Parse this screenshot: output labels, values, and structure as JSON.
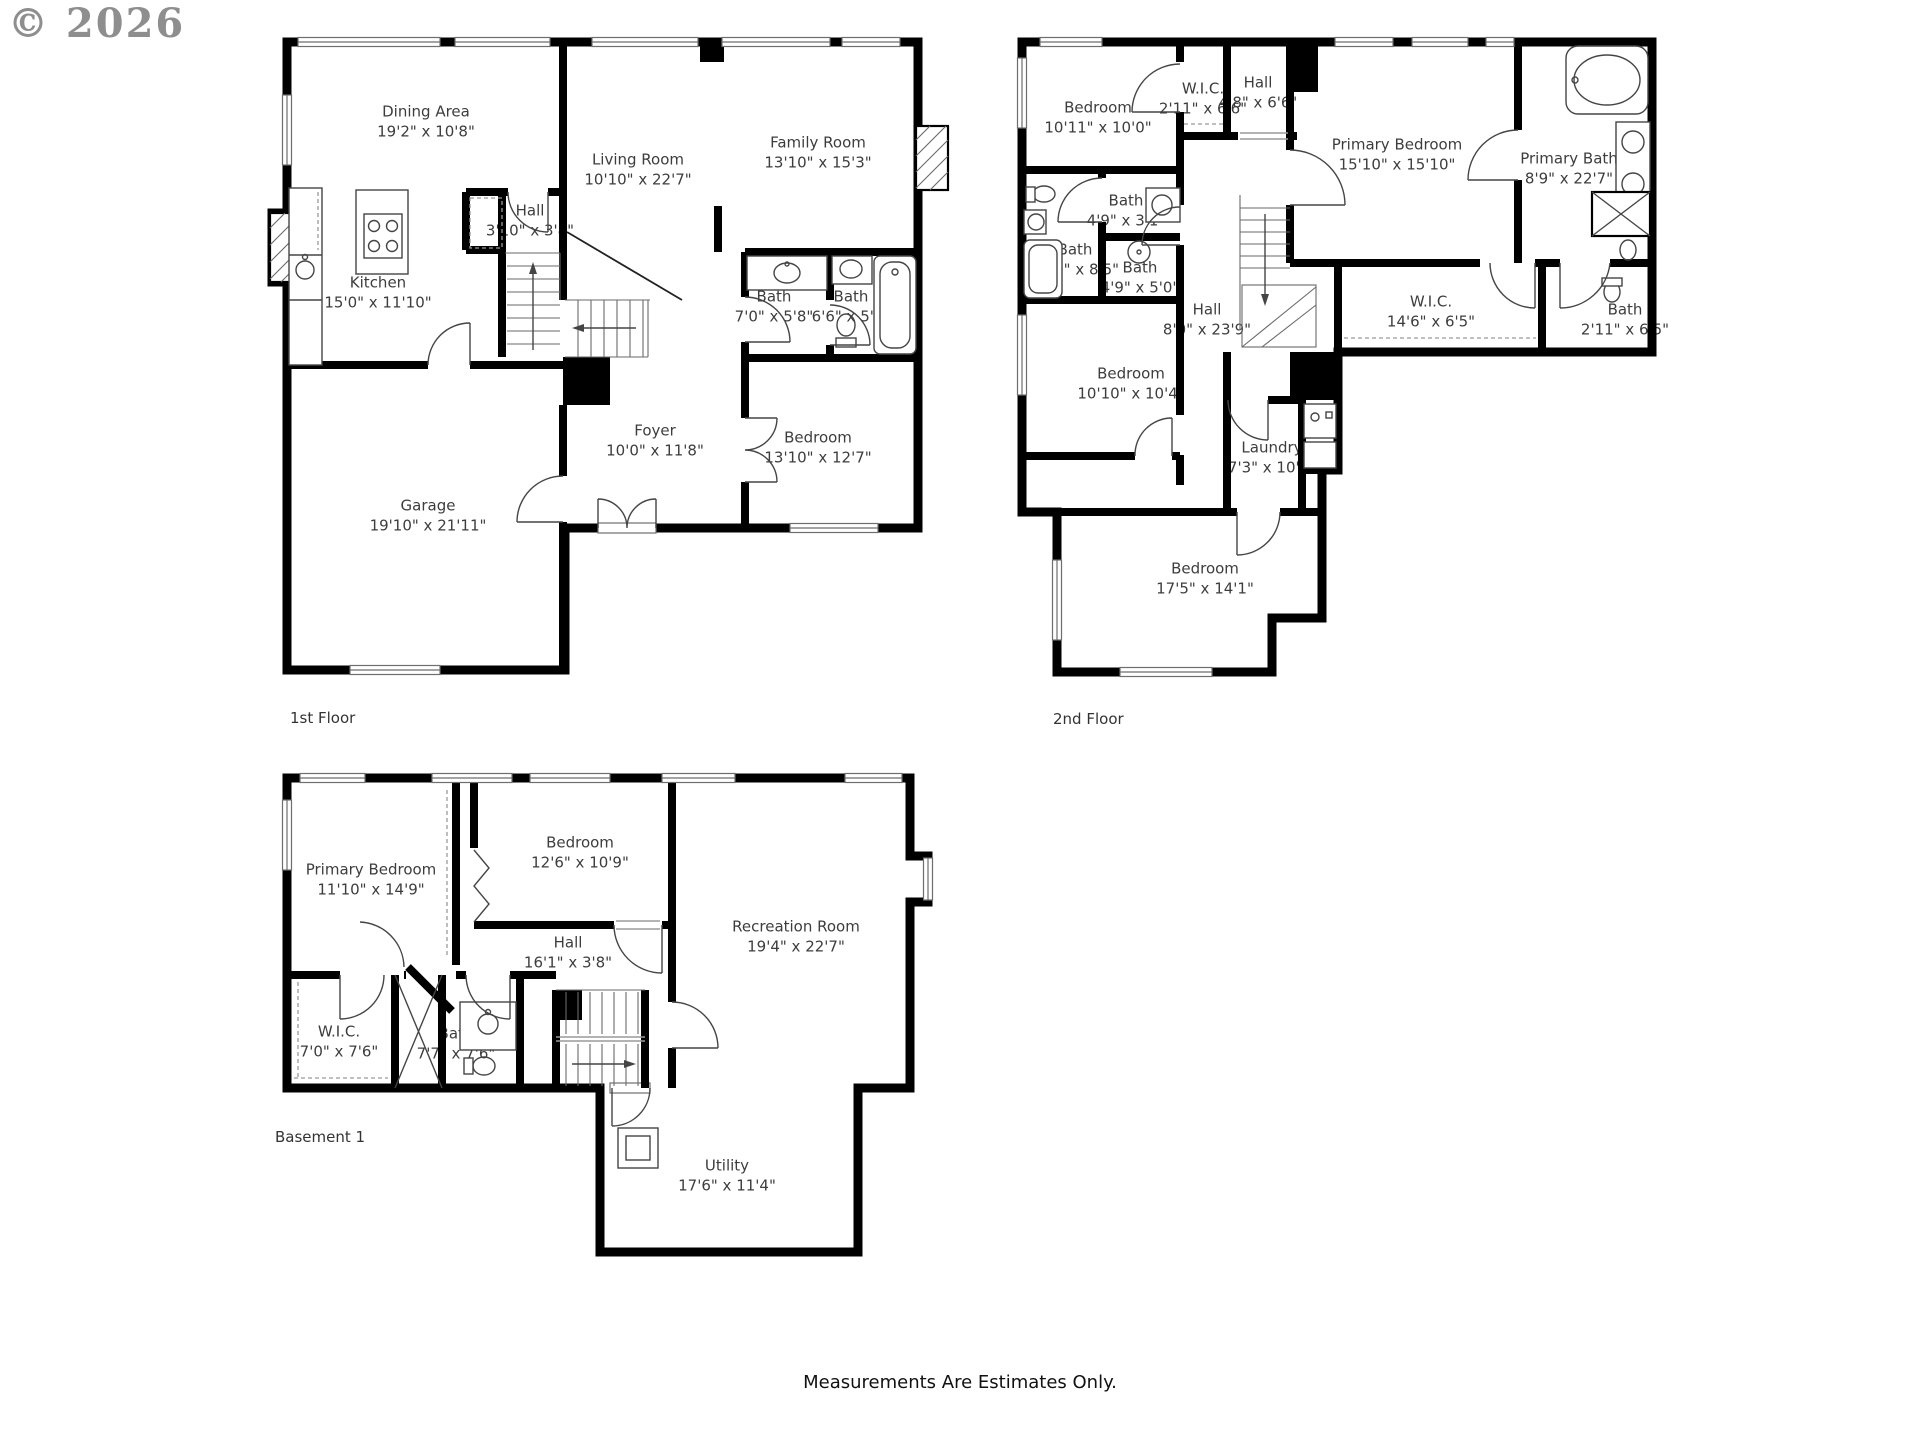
{
  "watermark": "© 2026",
  "footer": "Measurements Are Estimates Only.",
  "floors": [
    {
      "label": "1st Floor",
      "rooms": [
        {
          "name": "Dining Area",
          "dims": "19'2\" x 10'8\""
        },
        {
          "name": "Living Room",
          "dims": "10'10\" x 22'7\""
        },
        {
          "name": "Family Room",
          "dims": "13'10\" x 15'3\""
        },
        {
          "name": "Hall",
          "dims": "3'10\" x 3'8\""
        },
        {
          "name": "Kitchen",
          "dims": "15'0\" x 11'10\""
        },
        {
          "name": "Bath",
          "dims": "7'0\" x 5'8\""
        },
        {
          "name": "Bath",
          "dims": "6'6\" x 5'8\""
        },
        {
          "name": "Foyer",
          "dims": "10'0\" x 11'8\""
        },
        {
          "name": "Bedroom",
          "dims": "13'10\" x 12'7\""
        },
        {
          "name": "Garage",
          "dims": "19'10\" x 21'11\""
        }
      ]
    },
    {
      "label": "2nd Floor",
      "rooms": [
        {
          "name": "Bedroom",
          "dims": "10'11\" x 10'0\""
        },
        {
          "name": "W.I.C.",
          "dims": "2'11\" x 6'6\""
        },
        {
          "name": "Hall",
          "dims": "4'8\" x 6'6\""
        },
        {
          "name": "Primary Bedroom",
          "dims": "15'10\" x 15'10\""
        },
        {
          "name": "Primary Bath",
          "dims": "8'9\" x 22'7\""
        },
        {
          "name": "Bath",
          "dims": "4'9\" x 3'1\""
        },
        {
          "name": "Bath",
          "dims": "5'10\" x 8'5\""
        },
        {
          "name": "Bath",
          "dims": "4'9\" x 5'0\""
        },
        {
          "name": "Hall",
          "dims": "8'0\" x 23'9\""
        },
        {
          "name": "W.I.C.",
          "dims": "14'6\" x 6'5\""
        },
        {
          "name": "Bath",
          "dims": "2'11\" x 6'5\""
        },
        {
          "name": "Bedroom",
          "dims": "10'10\" x 10'4\""
        },
        {
          "name": "Laundry",
          "dims": "7'3\" x 10'5\""
        },
        {
          "name": "Bedroom",
          "dims": "17'5\" x 14'1\""
        }
      ]
    },
    {
      "label": "Basement 1",
      "rooms": [
        {
          "name": "Primary Bedroom",
          "dims": "11'10\" x 14'9\""
        },
        {
          "name": "Bedroom",
          "dims": "12'6\" x 10'9\""
        },
        {
          "name": "Recreation Room",
          "dims": "19'4\" x 22'7\""
        },
        {
          "name": "Hall",
          "dims": "16'1\" x 3'8\""
        },
        {
          "name": "W.I.C.",
          "dims": "7'0\" x 7'6\""
        },
        {
          "name": "Bath",
          "dims": "7'7\" x 7'6\""
        },
        {
          "name": "Utility",
          "dims": "17'6\" x 11'4\""
        }
      ]
    }
  ]
}
